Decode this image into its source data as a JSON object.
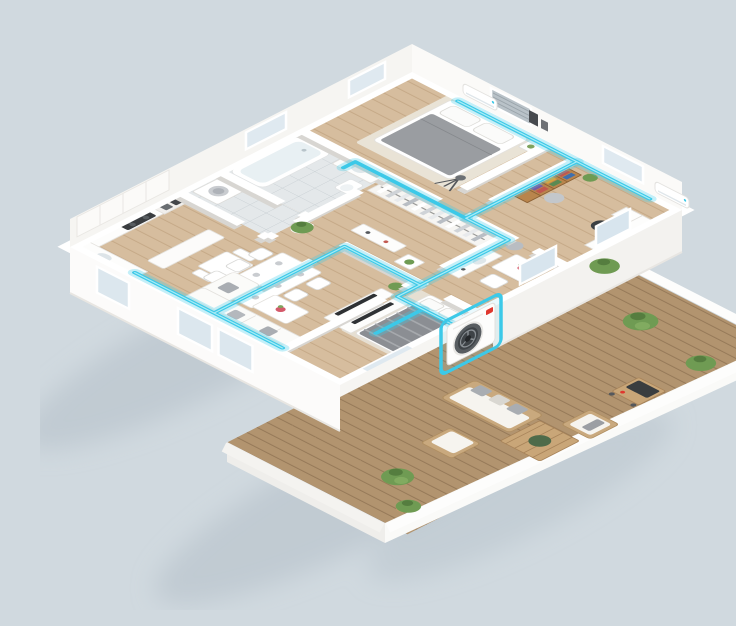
{
  "scene": {
    "title": "3D isometric floor plan render of an apartment with a ducted air-conditioning system and outdoor terrace",
    "background_color": "#d0d9df"
  },
  "palette": {
    "background": "#d0d9df",
    "wall_top": "#ffffff",
    "wall_face": "#f6f5f2",
    "wall_shadow": "#d8d6d2",
    "interior_wood_floor": "#d6bd9e",
    "deck_wood_floor": "#b2946f",
    "tile_floor": "#e4e8ea",
    "duct_cyan": "#3cc9e8",
    "duct_highlight": "#a8ecf6",
    "fabric_gray": "#9b9ea3",
    "furniture_wood": "#c9a678",
    "screen_dark": "#2f3235",
    "accent_red": "#e0372e",
    "plant_green": "#6f9b53",
    "pot_terracotta": "#c49a6e"
  },
  "building": {
    "rooms": [
      {
        "id": "master-bedroom",
        "label": "Master bedroom with gray double bed, nightstand, tripod lamp and wall AC unit"
      },
      {
        "id": "bathroom",
        "label": "Bathroom with bathtub, vanity sink and toilet"
      },
      {
        "id": "laundry-wc",
        "label": "Laundry room with washing machine"
      },
      {
        "id": "kitchen",
        "label": "Kitchen with L-shaped counter, cooktop, oven column, bar peninsula and breakfast table"
      },
      {
        "id": "living-dining",
        "label": "Open living and dining room with six-seat dining table, L-shaped sectional sofa, coffee table and TV console"
      },
      {
        "id": "hallway-closet",
        "label": "Central hallway with walk-in wardrobe of hanging clothes and dresser"
      },
      {
        "id": "office",
        "label": "Home office with bookshelf, desk, monitor, office chair and pouf"
      },
      {
        "id": "vanity-nook",
        "label": "Small room with vanity sink, flower table, chair and pouf"
      },
      {
        "id": "bedroom-2",
        "label": "Second bedroom with striped bed, dresser and TV"
      },
      {
        "id": "terrace-deck",
        "label": "Outdoor wooden terrace with patio sofa set, coffee table, armchairs, barbecue grill and potted plants"
      }
    ]
  },
  "hvac": {
    "ducts": {
      "color": "#3cc9e8",
      "style": "floor and wall-top duct runs with branch junctions"
    },
    "outdoor_unit": {
      "label": "Outdoor condenser unit highlighted with cyan outline",
      "body_color": "#fdfdfc",
      "fan_color": "#3e4347",
      "logo_color": "#e0372e",
      "highlight_color": "#3cc9e8"
    },
    "indoor_units": [
      {
        "location": "master bedroom back wall"
      },
      {
        "location": "office back wall"
      }
    ]
  },
  "landscaping": {
    "potted_plant_count": 8,
    "pot_color": "#c49a6e"
  }
}
